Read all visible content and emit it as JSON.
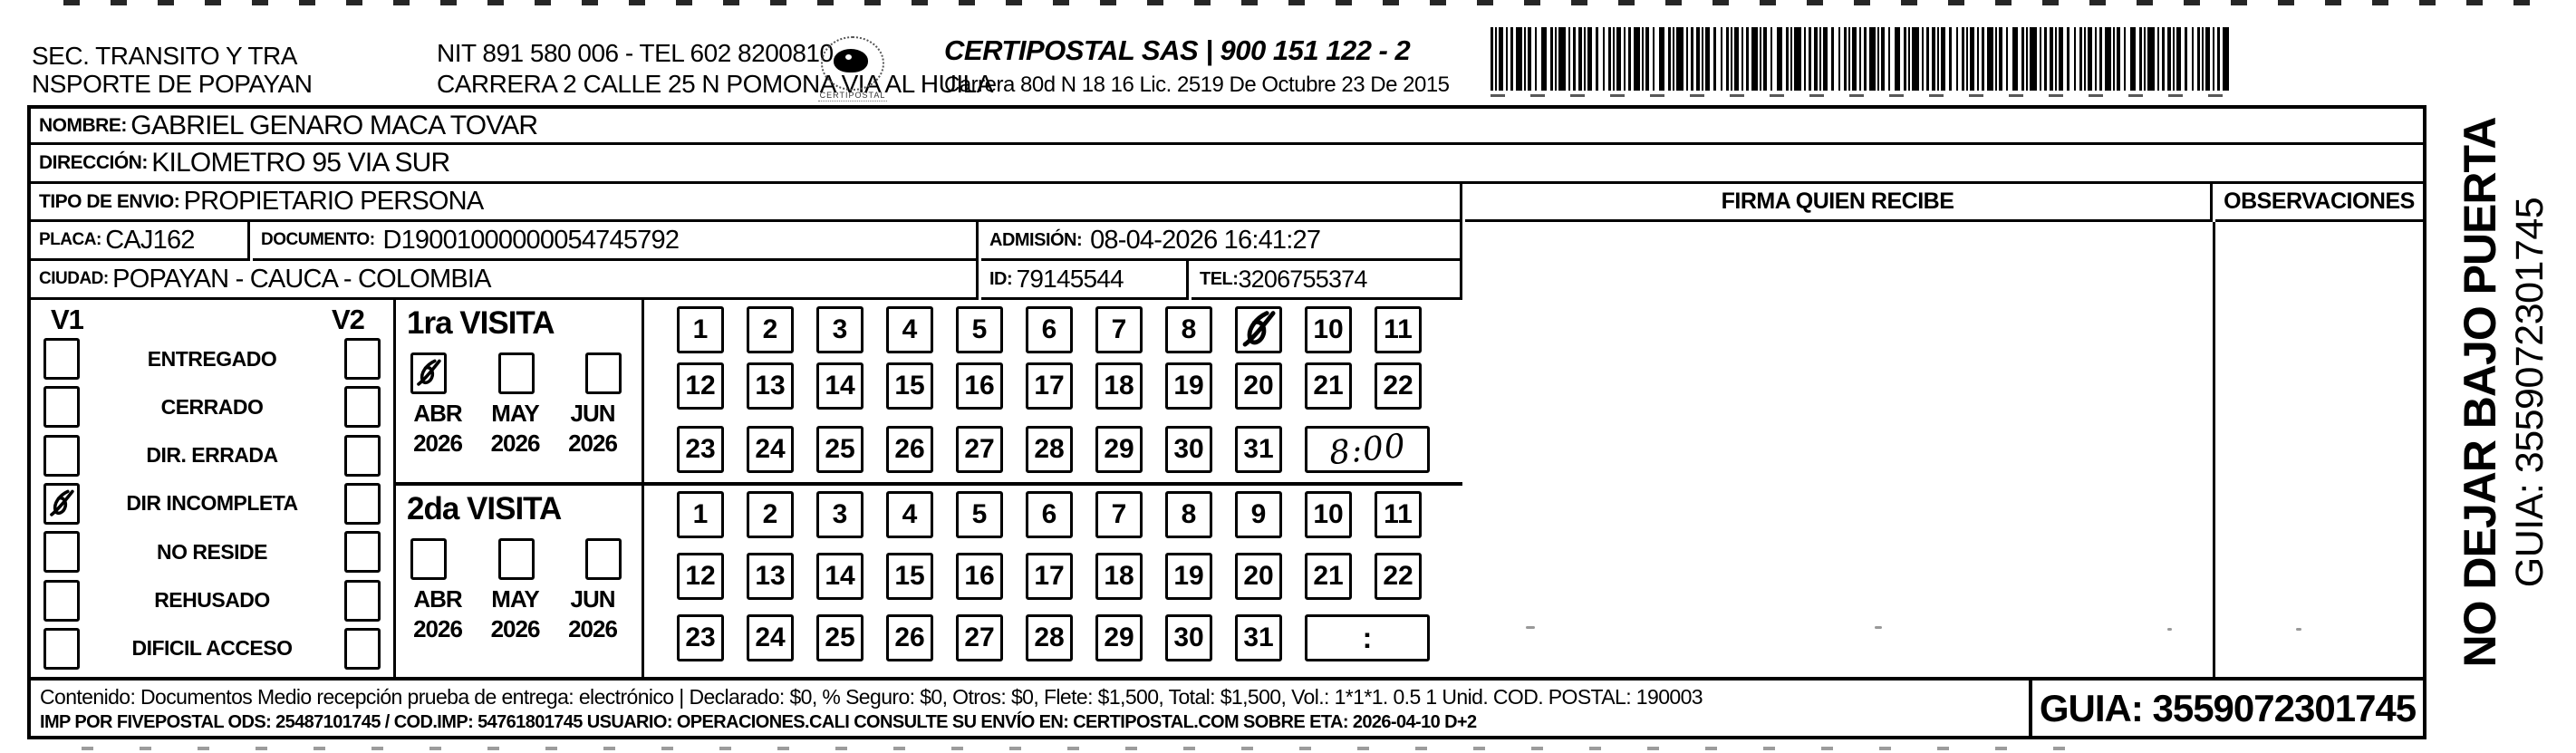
{
  "header": {
    "sender_line1": "SEC. TRANSITO Y TRA",
    "sender_line2": "NSPORTE DE POPAYAN",
    "nit_line": "NIT 891 580 006 - TEL 602 8200810",
    "address_line": "CARRERA 2 CALLE 25 N POMONA VIA AL HUILA",
    "logo_text": "CERTIPOSTAL",
    "company_line": "CERTIPOSTAL SAS | 900 151 122 - 2",
    "license_line": "Carrera 80d N 18 16  Lic. 2519 De Octubre 23 De 2015"
  },
  "fields": {
    "nombre_label": "NOMBRE:",
    "nombre": "GABRIEL GENARO MACA TOVAR",
    "direccion_label": "DIRECCIÓN:",
    "direccion": "KILOMETRO 95 VIA SUR",
    "tipo_label": "TIPO DE ENVIO:",
    "tipo": "PROPIETARIO PERSONA",
    "placa_label": "PLACA:",
    "placa": "CAJ162",
    "documento_label": "DOCUMENTO:",
    "documento": "D19001000000054745792",
    "admision_label": "ADMISIÓN:",
    "admision": "08-04-2026 16:41:27",
    "ciudad_label": "CIUDAD:",
    "ciudad": "POPAYAN - CAUCA - COLOMBIA",
    "id_label": "ID:",
    "id_value": "79145544",
    "tel_label": "TEL:",
    "tel_value": "3206755374"
  },
  "columns": {
    "firma_title": "FIRMA QUIEN RECIBE",
    "observaciones_title": "OBSERVACIONES"
  },
  "status": {
    "v1_label": "V1",
    "v2_label": "V2",
    "options": [
      "ENTREGADO",
      "CERRADO",
      "DIR. ERRADA",
      "DIR INCOMPLETA",
      "NO RESIDE",
      "REHUSADO",
      "DIFICIL ACCESO"
    ],
    "v1_checked_index": 3,
    "v2_checked_index": -1
  },
  "visits": {
    "first": {
      "title": "1ra VISITA",
      "months": [
        "ABR",
        "MAY",
        "JUN"
      ],
      "years": [
        "2026",
        "2026",
        "2026"
      ],
      "checked_month_index": 0,
      "day_rows": [
        [
          "1",
          "2",
          "3",
          "4",
          "5",
          "6",
          "7",
          "8",
          "9",
          "10",
          "11"
        ],
        [
          "12",
          "13",
          "14",
          "15",
          "16",
          "17",
          "18",
          "19",
          "20",
          "21",
          "22"
        ],
        [
          "23",
          "24",
          "25",
          "26",
          "27",
          "28",
          "29",
          "30",
          "31"
        ]
      ],
      "marked_day": "9",
      "time": "8:00",
      "time_handwritten": true
    },
    "second": {
      "title": "2da VISITA",
      "months": [
        "ABR",
        "MAY",
        "JUN"
      ],
      "years": [
        "2026",
        "2026",
        "2026"
      ],
      "checked_month_index": -1,
      "day_rows": [
        [
          "1",
          "2",
          "3",
          "4",
          "5",
          "6",
          "7",
          "8",
          "9",
          "10",
          "11"
        ],
        [
          "12",
          "13",
          "14",
          "15",
          "16",
          "17",
          "18",
          "19",
          "20",
          "21",
          "22"
        ],
        [
          "23",
          "24",
          "25",
          "26",
          "27",
          "28",
          "29",
          "30",
          "31"
        ]
      ],
      "marked_day": "",
      "time": ":",
      "time_handwritten": false
    }
  },
  "footer": {
    "line1": "Contenido: Documentos Medio recepción prueba de entrega: electrónico | Declarado: $0, % Seguro: $0, Otros: $0, Flete: $1,500, Total: $1,500, Vol.: 1*1*1. 0.5  1 Unid. COD. POSTAL: 190003",
    "line2": "IMP POR FIVEPOSTAL ODS: 25487101745 / COD.IMP: 54761801745 USUARIO: OPERACIONES.CALI CONSULTE SU ENVÍO EN: CERTIPOSTAL.COM SOBRE ETA: 2026-04-10 D+2",
    "guia_box": "GUIA: 3559072301745"
  },
  "side": {
    "warning": "NO DEJAR BAJO PUERTA",
    "guia": "GUIA: 3559072301745"
  }
}
